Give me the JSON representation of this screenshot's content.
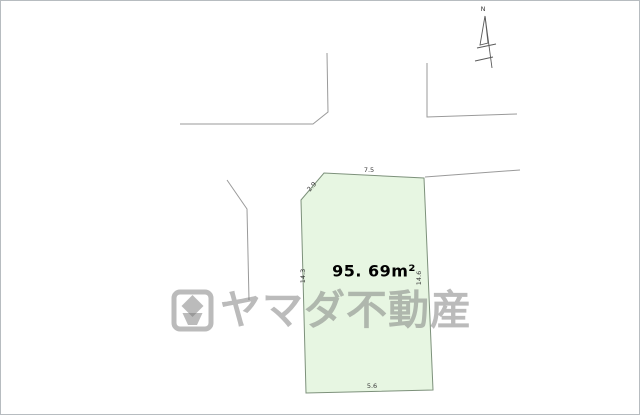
{
  "diagram": {
    "title": "land-plot-site-plan",
    "area_label": "95. 69m²",
    "dimensions": {
      "top": "7.5",
      "chamfer": "2.9",
      "left": "14.3",
      "right": "14.6",
      "bottom": "5.6"
    },
    "parcel_fill": "#e7f6e2",
    "parcel_border": "#7d917b",
    "road_line_color": "#9a9a9a"
  },
  "compass": {
    "north_label": "N"
  },
  "watermark": {
    "text": "ヤマダ不動産",
    "logo": "yamada-logo-icon",
    "color": "#c7c7c7"
  }
}
